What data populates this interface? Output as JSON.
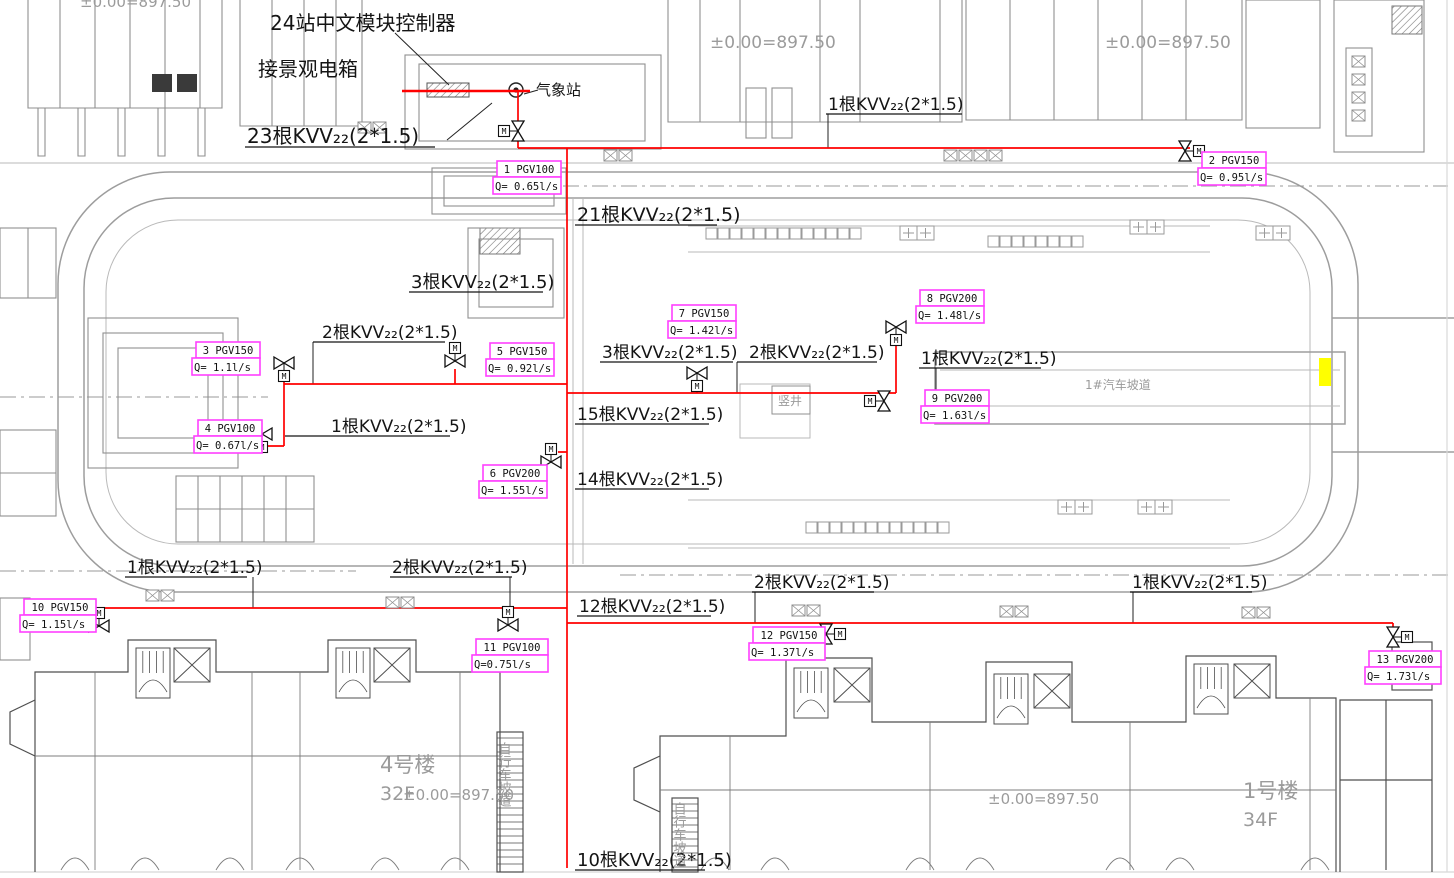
{
  "drawing": {
    "notes": {
      "controller": "24站中文模块控制器",
      "landscape_box": "接景观电箱",
      "weather_station": "气象站",
      "shaft": "竖井",
      "car_ramp": "1#汽车坡道",
      "bike_ramp_1": "自行车坡道",
      "bike_ramp_2": "自行车坡道",
      "level_top_left": "±0.00=897.50",
      "level_top_center": "±0.00=897.50",
      "level_top_right": "±0.00=897.50",
      "level_bottom_left": "±0.00=897.50",
      "level_bottom_mid": "±0.00=897.50"
    },
    "buildings": {
      "left_name": "4号楼",
      "left_floors": "32F",
      "right_name": "1号楼",
      "right_floors": "34F"
    },
    "kvv_labels": [
      "23根KVV₂₂(2*1.5)",
      "1根KVV₂₂(2*1.5)",
      "21根KVV₂₂(2*1.5)",
      "3根KVV₂₂(2*1.5)",
      "2根KVV₂₂(2*1.5)",
      "3根KVV₂₂(2*1.5)",
      "2根KVV₂₂(2*1.5)",
      "1根KVV₂₂(2*1.5)",
      "15根KVV₂₂(2*1.5)",
      "1根KVV₂₂(2*1.5)",
      "14根KVV₂₂(2*1.5)",
      "1根KVV₂₂(2*1.5)",
      "2根KVV₂₂(2*1.5)",
      "12根KVV₂₂(2*1.5)",
      "2根KVV₂₂(2*1.5)",
      "1根KVV₂₂(2*1.5)",
      "10根KVV₂₂(2*1.5)"
    ],
    "pgv_valves": [
      {
        "id": "1",
        "label": "1 PGV100",
        "flow": "Q= 0.65l/s"
      },
      {
        "id": "2",
        "label": "2 PGV150",
        "flow": "Q= 0.95l/s"
      },
      {
        "id": "3",
        "label": "3 PGV150",
        "flow": "Q= 1.1l/s"
      },
      {
        "id": "4",
        "label": "4 PGV100",
        "flow": "Q= 0.67l/s"
      },
      {
        "id": "5",
        "label": "5 PGV150",
        "flow": "Q= 0.92l/s"
      },
      {
        "id": "6",
        "label": "6 PGV200",
        "flow": "Q= 1.55l/s"
      },
      {
        "id": "7",
        "label": "7 PGV150",
        "flow": "Q= 1.42l/s"
      },
      {
        "id": "8",
        "label": "8 PGV200",
        "flow": "Q= 1.48l/s"
      },
      {
        "id": "9",
        "label": "9 PGV200",
        "flow": "Q= 1.63l/s"
      },
      {
        "id": "10",
        "label": "10 PGV150",
        "flow": "Q= 1.15l/s"
      },
      {
        "id": "11",
        "label": "11 PGV100",
        "flow": "Q=0.75l/s"
      },
      {
        "id": "12",
        "label": "12 PGV150",
        "flow": "Q= 1.37l/s"
      },
      {
        "id": "13",
        "label": "13 PGV200",
        "flow": "Q= 1.73l/s"
      }
    ],
    "valve_actuator_label": "M",
    "colors": {
      "cable_red": "#ff0000",
      "label_magenta": "#ff40ff",
      "highlight_yellow": "#ffff00",
      "drawing_gray": "#8f8f8f"
    }
  }
}
